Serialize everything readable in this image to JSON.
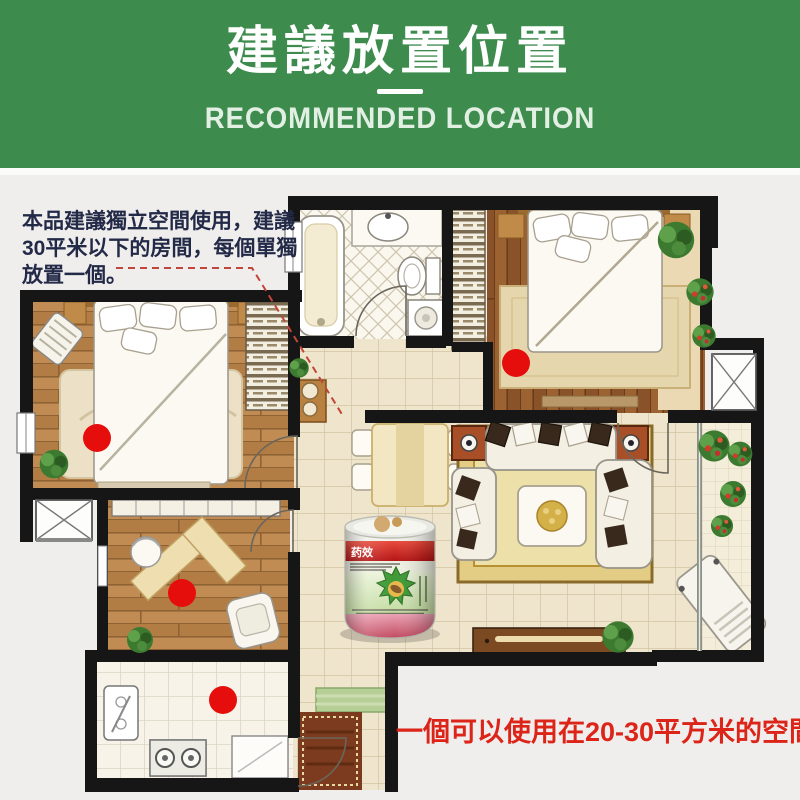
{
  "header": {
    "title": "建議放置位置",
    "subtitle": "RECOMMENDED LOCATION",
    "bg_color": "#3e8b4e"
  },
  "annotation": {
    "line1": "本品建議獨立空間使用，建議",
    "line2": "30平米以下的房間，每個單獨",
    "line3": "放置一個。"
  },
  "caption": {
    "text": "一個可以使用在20-30平方米的空間",
    "color": "#dc2418"
  },
  "product": {
    "brand": "药效"
  },
  "floorplan": {
    "marker_color": "#e60d0d",
    "marker_radius": 14,
    "markers": [
      {
        "name": "bedroom-left",
        "x": 97,
        "y": 438
      },
      {
        "name": "study",
        "x": 182,
        "y": 593
      },
      {
        "name": "kitchen",
        "x": 223,
        "y": 700
      },
      {
        "name": "bedroom-right",
        "x": 516,
        "y": 363
      }
    ]
  }
}
